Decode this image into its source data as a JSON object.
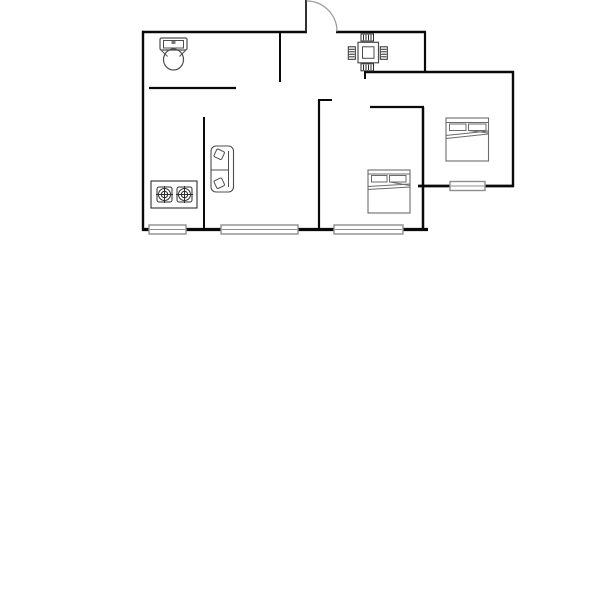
{
  "document": {
    "type": "apartment-floor-plan",
    "background": "#ffffff",
    "canvas_width": 600,
    "canvas_height": 591
  },
  "palette": {
    "wall": "#0a0a0a",
    "door_leaf": "#1a1a1a",
    "door_arc": "#9a9a9a",
    "window": "#8f8f8f",
    "window_fill": "#ffffff",
    "fixture": "#4d4d4d",
    "stove": "#2e2e2e",
    "chair": "#2b2b2b",
    "table": "#4d4d4d",
    "sofa": "#4d4d4d",
    "bed": "#6b6b6b"
  },
  "plan": {
    "walls": [
      {
        "name": "wall-top-west",
        "x1": 142,
        "y1": 32,
        "x2": 307,
        "y2": 32,
        "sw": 2.4
      },
      {
        "name": "wall-top-east",
        "x1": 336,
        "y1": 32,
        "x2": 426,
        "y2": 32,
        "sw": 2.4
      },
      {
        "name": "wall-west",
        "x1": 143,
        "y1": 30.8,
        "x2": 143,
        "y2": 231,
        "sw": 2.4
      },
      {
        "name": "wall-entry-east",
        "x1": 425,
        "y1": 32,
        "x2": 425,
        "y2": 72,
        "sw": 2.2
      },
      {
        "name": "wall-upper-mid",
        "x1": 364,
        "y1": 72,
        "x2": 514,
        "y2": 72,
        "sw": 2.4
      },
      {
        "name": "wall-dining-stub",
        "x1": 365,
        "y1": 71,
        "x2": 365,
        "y2": 79,
        "sw": 2
      },
      {
        "name": "wall-bath-east",
        "x1": 280,
        "y1": 32,
        "x2": 280,
        "y2": 82,
        "sw": 2
      },
      {
        "name": "wall-bath-south",
        "x1": 149,
        "y1": 88,
        "x2": 236,
        "y2": 88,
        "sw": 2.2
      },
      {
        "name": "wall-kitchen-east",
        "x1": 204,
        "y1": 117,
        "x2": 204,
        "y2": 230,
        "sw": 2
      },
      {
        "name": "wall-bedroom1-north",
        "x1": 370,
        "y1": 107,
        "x2": 424,
        "y2": 107,
        "sw": 2.2
      },
      {
        "name": "wall-bedroom1-notch",
        "x1": 318,
        "y1": 100,
        "x2": 332,
        "y2": 100,
        "sw": 2
      },
      {
        "name": "wall-bedroom1-west",
        "x1": 319,
        "y1": 100,
        "x2": 319,
        "y2": 230,
        "sw": 2.2
      },
      {
        "name": "wall-bedroom1-east",
        "x1": 423,
        "y1": 107,
        "x2": 423,
        "y2": 230,
        "sw": 2.5
      },
      {
        "name": "wall-bedroom2-south",
        "x1": 418,
        "y1": 186,
        "x2": 514,
        "y2": 186,
        "sw": 2.8
      },
      {
        "name": "wall-east",
        "x1": 513,
        "y1": 71,
        "x2": 513,
        "y2": 187,
        "sw": 2.4
      },
      {
        "name": "wall-south",
        "x1": 142,
        "y1": 229.5,
        "x2": 428,
        "y2": 229.5,
        "sw": 3.2
      }
    ],
    "door": {
      "name": "entry-door",
      "leaf": {
        "x1": 306,
        "y1": 0,
        "x2": 306,
        "y2": 32.5,
        "sw": 1.8
      },
      "arc": {
        "d": "M 306.5 1 A 30.5 30.5 0 0 1 337 31.5",
        "sw": 1.2
      }
    },
    "windows": [
      {
        "name": "window-kitchen",
        "x": 149,
        "y": 225,
        "w": 37,
        "h": 9
      },
      {
        "name": "window-living-room",
        "x": 221,
        "y": 225,
        "w": 77,
        "h": 9
      },
      {
        "name": "window-bedroom1",
        "x": 334,
        "y": 225,
        "w": 69,
        "h": 9
      },
      {
        "name": "window-bedroom2",
        "x": 450,
        "y": 181.5,
        "w": 35,
        "h": 9
      }
    ],
    "furniture": [
      {
        "name": "toilet",
        "stroke": "#4d4d4d",
        "shapes": [
          {
            "t": "rect",
            "x": 160,
            "y": 38,
            "w": 27,
            "h": 12,
            "r": 1.5,
            "sw": 1.2
          },
          {
            "t": "rect",
            "x": 163.5,
            "y": 40.5,
            "w": 20,
            "h": 7.5,
            "sw": 1
          },
          {
            "t": "rect",
            "x": 171.5,
            "y": 41,
            "w": 4,
            "h": 3,
            "fill": "#777777",
            "stroke": "none"
          },
          {
            "t": "ellipse",
            "cx": 173.5,
            "cy": 59.5,
            "rx": 10,
            "ry": 10.5,
            "sw": 1.2
          },
          {
            "t": "line",
            "x1": 161.5,
            "y1": 50.5,
            "x2": 167.5,
            "y2": 56.5,
            "sw": 1
          },
          {
            "t": "line",
            "x1": 185.5,
            "y1": 50.5,
            "x2": 179.5,
            "y2": 56.5,
            "sw": 1
          }
        ]
      },
      {
        "name": "gas-stove",
        "stroke": "#2e2e2e",
        "shapes": [
          {
            "t": "rect",
            "x": 151,
            "y": 181,
            "w": 46,
            "h": 27,
            "sw": 1.1
          },
          {
            "t": "rect",
            "x": 157,
            "y": 187,
            "w": 15,
            "h": 15,
            "r": 2,
            "sw": 1
          },
          {
            "t": "circle",
            "cx": 164.5,
            "cy": 194.5,
            "r": 6,
            "sw": 1
          },
          {
            "t": "circle",
            "cx": 164.5,
            "cy": 194.5,
            "r": 3.2,
            "sw": 1
          },
          {
            "t": "line",
            "x1": 156,
            "y1": 194.5,
            "x2": 173,
            "y2": 194.5,
            "sw": 1
          },
          {
            "t": "line",
            "x1": 164.5,
            "y1": 186,
            "x2": 164.5,
            "y2": 203,
            "sw": 1
          },
          {
            "t": "rect",
            "x": 177,
            "y": 187,
            "w": 15,
            "h": 15,
            "r": 2,
            "sw": 1
          },
          {
            "t": "circle",
            "cx": 184.5,
            "cy": 194.5,
            "r": 6,
            "sw": 1
          },
          {
            "t": "circle",
            "cx": 184.5,
            "cy": 194.5,
            "r": 3.2,
            "sw": 1
          },
          {
            "t": "line",
            "x1": 176,
            "y1": 194.5,
            "x2": 193,
            "y2": 194.5,
            "sw": 1
          },
          {
            "t": "line",
            "x1": 184.5,
            "y1": 186,
            "x2": 184.5,
            "y2": 203,
            "sw": 1
          }
        ]
      },
      {
        "name": "sofa",
        "stroke": "#4d4d4d",
        "shapes": [
          {
            "t": "rect",
            "x": 211,
            "y": 146,
            "w": 22.5,
            "h": 46,
            "r": 5,
            "sw": 1.1
          },
          {
            "t": "line",
            "x1": 228.5,
            "y1": 151,
            "x2": 228.5,
            "y2": 187,
            "sw": 1
          },
          {
            "t": "line",
            "x1": 211.5,
            "y1": 170,
            "x2": 228.5,
            "y2": 170,
            "sw": 1
          },
          {
            "t": "rect",
            "x": 215,
            "y": 150,
            "w": 8.5,
            "h": 8.5,
            "r": 1.5,
            "sw": 1,
            "rot": "25 219.2 154.2"
          },
          {
            "t": "rect",
            "x": 215,
            "y": 179,
            "w": 8.5,
            "h": 8.5,
            "r": 1.5,
            "sw": 1,
            "rot": "-25 219.2 183.2"
          }
        ]
      },
      {
        "name": "dining-table",
        "stroke": "#4d4d4d",
        "shapes": [
          {
            "t": "rect",
            "x": 358,
            "y": 42.3,
            "w": 20.5,
            "h": 20.5,
            "sw": 1.2
          },
          {
            "t": "rect",
            "x": 362.5,
            "y": 46.8,
            "w": 11.5,
            "h": 11.5,
            "sw": 1
          },
          {
            "t": "rect",
            "x": 361,
            "y": 34,
            "w": 12.5,
            "h": 7,
            "sw": 1,
            "stroke": "#2b2b2b"
          },
          {
            "t": "line",
            "x1": 363.5,
            "y1": 34.8,
            "x2": 363.5,
            "y2": 40.2,
            "sw": 1,
            "stroke": "#2b2b2b"
          },
          {
            "t": "line",
            "x1": 366,
            "y1": 34.8,
            "x2": 366,
            "y2": 40.2,
            "sw": 1,
            "stroke": "#2b2b2b"
          },
          {
            "t": "line",
            "x1": 368.5,
            "y1": 34.8,
            "x2": 368.5,
            "y2": 40.2,
            "sw": 1,
            "stroke": "#2b2b2b"
          },
          {
            "t": "line",
            "x1": 371,
            "y1": 34.8,
            "x2": 371,
            "y2": 40.2,
            "sw": 1,
            "stroke": "#2b2b2b"
          },
          {
            "t": "rect",
            "x": 361,
            "y": 63.8,
            "w": 12.5,
            "h": 7,
            "sw": 1,
            "stroke": "#2b2b2b"
          },
          {
            "t": "line",
            "x1": 363.5,
            "y1": 64.6,
            "x2": 363.5,
            "y2": 70,
            "sw": 1,
            "stroke": "#2b2b2b"
          },
          {
            "t": "line",
            "x1": 366,
            "y1": 64.6,
            "x2": 366,
            "y2": 70,
            "sw": 1,
            "stroke": "#2b2b2b"
          },
          {
            "t": "line",
            "x1": 368.5,
            "y1": 64.6,
            "x2": 368.5,
            "y2": 70,
            "sw": 1,
            "stroke": "#2b2b2b"
          },
          {
            "t": "line",
            "x1": 371,
            "y1": 64.6,
            "x2": 371,
            "y2": 70,
            "sw": 1,
            "stroke": "#2b2b2b"
          },
          {
            "t": "rect",
            "x": 348.3,
            "y": 46.8,
            "w": 7,
            "h": 12.5,
            "sw": 1,
            "stroke": "#2b2b2b"
          },
          {
            "t": "line",
            "x1": 349.1,
            "y1": 49.3,
            "x2": 354.5,
            "y2": 49.3,
            "sw": 1,
            "stroke": "#2b2b2b"
          },
          {
            "t": "line",
            "x1": 349.1,
            "y1": 51.8,
            "x2": 354.5,
            "y2": 51.8,
            "sw": 1,
            "stroke": "#2b2b2b"
          },
          {
            "t": "line",
            "x1": 349.1,
            "y1": 54.3,
            "x2": 354.5,
            "y2": 54.3,
            "sw": 1,
            "stroke": "#2b2b2b"
          },
          {
            "t": "line",
            "x1": 349.1,
            "y1": 56.8,
            "x2": 354.5,
            "y2": 56.8,
            "sw": 1,
            "stroke": "#2b2b2b"
          },
          {
            "t": "rect",
            "x": 380.3,
            "y": 46.8,
            "w": 7,
            "h": 12.5,
            "sw": 1,
            "stroke": "#2b2b2b"
          },
          {
            "t": "line",
            "x1": 381.1,
            "y1": 49.3,
            "x2": 386.5,
            "y2": 49.3,
            "sw": 1,
            "stroke": "#2b2b2b"
          },
          {
            "t": "line",
            "x1": 381.1,
            "y1": 51.8,
            "x2": 386.5,
            "y2": 51.8,
            "sw": 1,
            "stroke": "#2b2b2b"
          },
          {
            "t": "line",
            "x1": 381.1,
            "y1": 54.3,
            "x2": 386.5,
            "y2": 54.3,
            "sw": 1,
            "stroke": "#2b2b2b"
          },
          {
            "t": "line",
            "x1": 381.1,
            "y1": 56.8,
            "x2": 386.5,
            "y2": 56.8,
            "sw": 1,
            "stroke": "#2b2b2b"
          }
        ]
      },
      {
        "name": "bed-bedroom1",
        "stroke": "#6b6b6b",
        "shapes": [
          {
            "t": "rect",
            "x": 368,
            "y": 170,
            "w": 42,
            "h": 43,
            "sw": 1.1
          },
          {
            "t": "line",
            "x1": 368,
            "y1": 174,
            "x2": 410,
            "y2": 174,
            "sw": 1
          },
          {
            "t": "rect",
            "x": 371.5,
            "y": 175.5,
            "w": 15.5,
            "h": 6.5,
            "sw": 1
          },
          {
            "t": "rect",
            "x": 389.5,
            "y": 175.5,
            "w": 16.5,
            "h": 6.5,
            "sw": 1
          },
          {
            "t": "line",
            "x1": 368,
            "y1": 186.5,
            "x2": 410,
            "y2": 184,
            "sw": 1
          },
          {
            "t": "line",
            "x1": 368,
            "y1": 189.5,
            "x2": 410,
            "y2": 187,
            "sw": 1
          },
          {
            "t": "line",
            "x1": 390,
            "y1": 182,
            "x2": 410,
            "y2": 185.5,
            "sw": 1
          }
        ]
      },
      {
        "name": "bed-bedroom2",
        "stroke": "#6b6b6b",
        "shapes": [
          {
            "t": "rect",
            "x": 446,
            "y": 118,
            "w": 42.5,
            "h": 43,
            "sw": 1.1
          },
          {
            "t": "line",
            "x1": 446,
            "y1": 122.5,
            "x2": 488.5,
            "y2": 122.5,
            "sw": 1
          },
          {
            "t": "rect",
            "x": 449.5,
            "y": 124,
            "w": 16.5,
            "h": 6.5,
            "sw": 1
          },
          {
            "t": "rect",
            "x": 468.5,
            "y": 124,
            "w": 17.5,
            "h": 6.5,
            "sw": 1
          },
          {
            "t": "line",
            "x1": 446,
            "y1": 135.5,
            "x2": 488.5,
            "y2": 131,
            "sw": 1
          },
          {
            "t": "line",
            "x1": 446,
            "y1": 138.5,
            "x2": 488.5,
            "y2": 134,
            "sw": 1
          },
          {
            "t": "line",
            "x1": 468.5,
            "y1": 130.5,
            "x2": 488.5,
            "y2": 133,
            "sw": 1
          }
        ]
      }
    ]
  }
}
